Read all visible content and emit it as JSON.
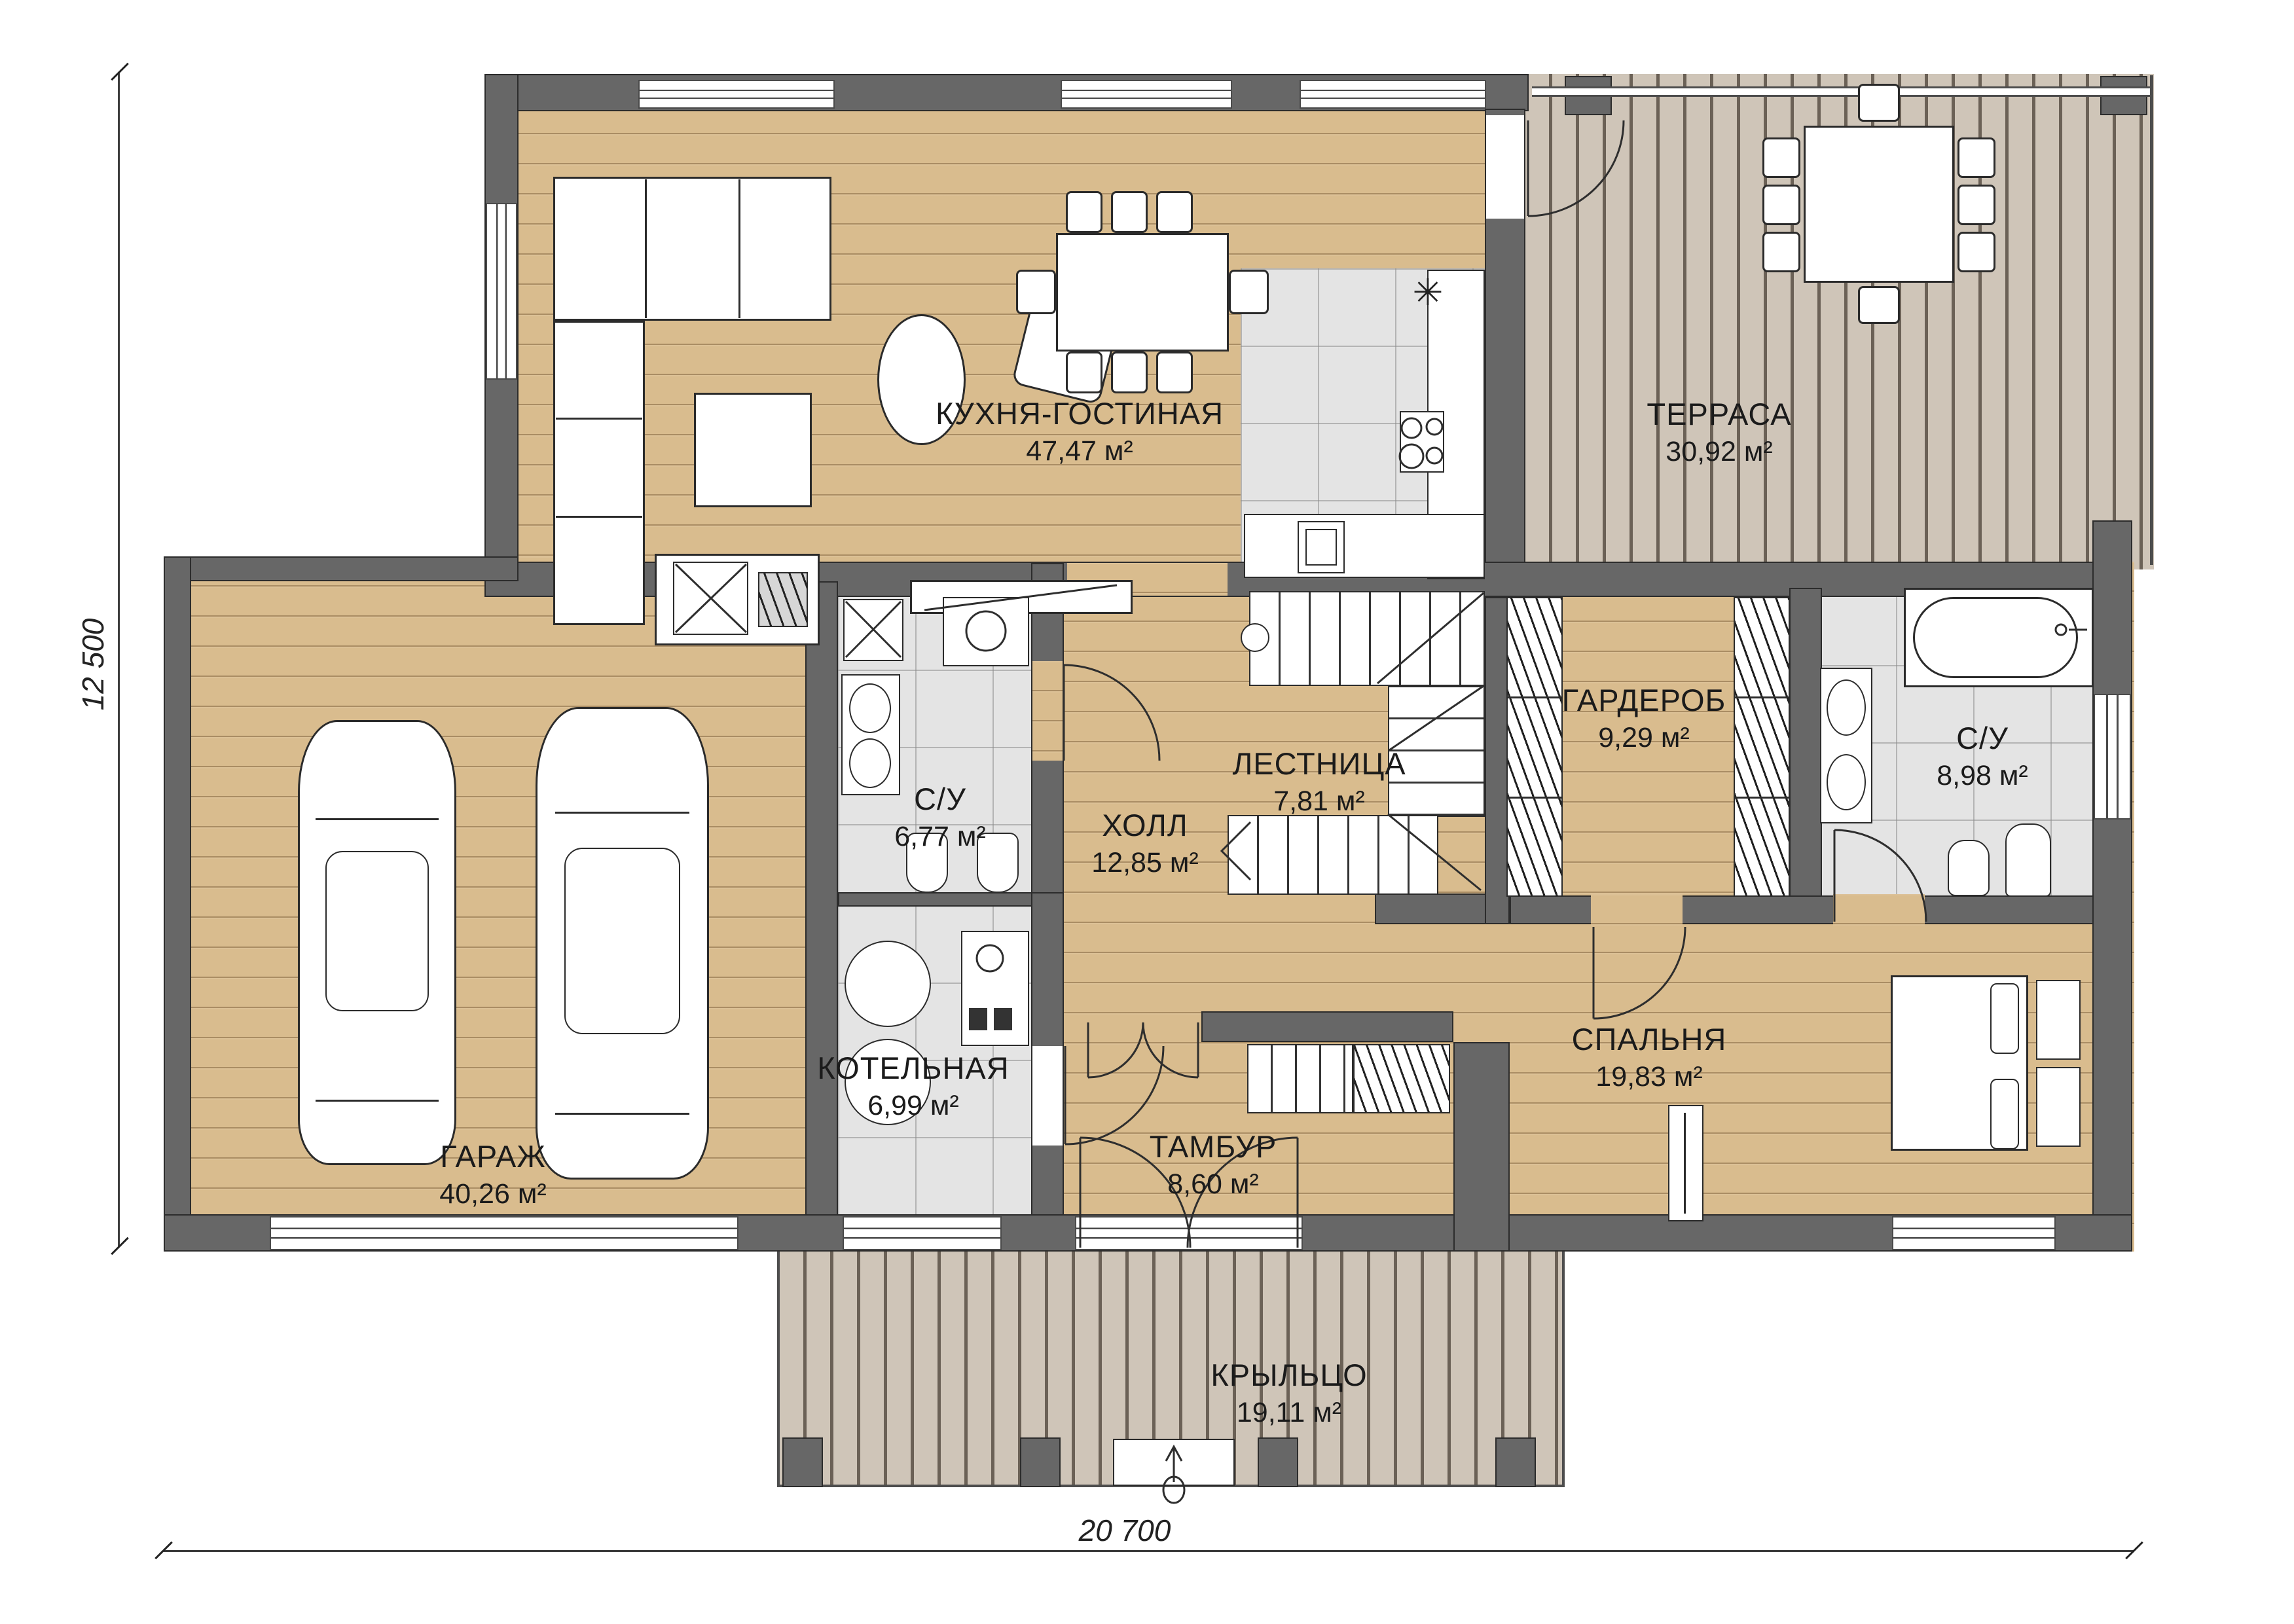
{
  "plan": {
    "rooms": [
      {
        "id": "kitchen-living",
        "name": "КУХНЯ-ГОСТИНАЯ",
        "area": "47,47 м²"
      },
      {
        "id": "terrace",
        "name": "ТЕРРАСА",
        "area": "30,92 м²"
      },
      {
        "id": "garage",
        "name": "ГАРАЖ",
        "area": "40,26 м²"
      },
      {
        "id": "bathroom-1",
        "name": "С/У",
        "area": "6,77 м²"
      },
      {
        "id": "hall",
        "name": "ХОЛЛ",
        "area": "12,85 м²"
      },
      {
        "id": "staircase",
        "name": "ЛЕСТНИЦА",
        "area": "7,81 м²"
      },
      {
        "id": "wardrobe",
        "name": "ГАРДЕРОБ",
        "area": "9,29 м²"
      },
      {
        "id": "bathroom-2",
        "name": "С/У",
        "area": "8,98 м²"
      },
      {
        "id": "boiler-room",
        "name": "КОТЕЛЬНАЯ",
        "area": "6,99 м²"
      },
      {
        "id": "vestibule",
        "name": "ТАМБУР",
        "area": "8,60 м²"
      },
      {
        "id": "bedroom",
        "name": "СПАЛЬНЯ",
        "area": "19,83 м²"
      },
      {
        "id": "porch",
        "name": "КРЫЛЬЦО",
        "area": "19,11 м²"
      }
    ],
    "dimensions": {
      "height": "12 500",
      "width": "20 700"
    },
    "icons": {
      "kitchen_sink_glyph": "✳"
    },
    "colors": {
      "wall": "#676767",
      "wood_floor": "#d9bc8e",
      "deck": "#cfc5b8",
      "tile": "#e4e4e4",
      "outline": "#2b2b2b"
    }
  }
}
